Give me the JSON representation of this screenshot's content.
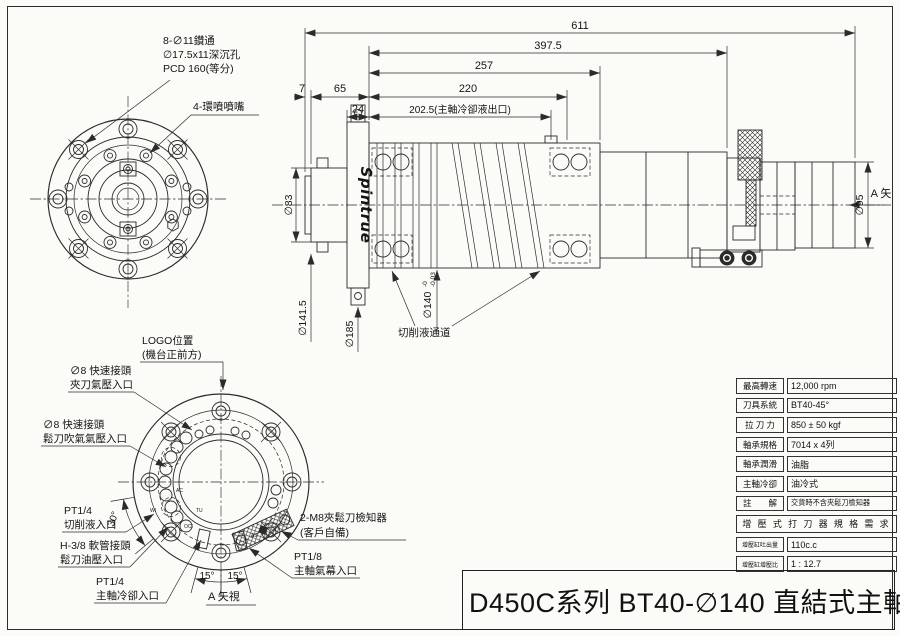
{
  "front_view": {
    "note1": "8-∅11鑽通",
    "note2": "∅17.5x11深沉孔",
    "note3": "PCD 160(等分)",
    "nozzle_note": "4-環噴噴嘴"
  },
  "dims": {
    "overall": "611",
    "d397": "397.5",
    "d257": "257",
    "d220": "220",
    "d202": "202.5(主軸冷卻液出口)",
    "d7": "7",
    "d65": "65",
    "d24": "24",
    "dia83": "∅83",
    "dia141": "∅141.5",
    "dia185": "∅185",
    "dia140": "∅140",
    "dia140_tol_top": "-0",
    "dia140_tol_bot": "-0.03",
    "dia95": "∅95",
    "coolant_channel": "切削液通道",
    "view_arrow": "A 矢"
  },
  "side_view": {
    "logo": "Spintrue"
  },
  "rear_view": {
    "logo_line1": "LOGO位置",
    "logo_line2": "(機台正前方)",
    "clamp_line1": "∅8 快速接頭",
    "clamp_line2": "夾刀氣壓入口",
    "unclamp_line1": "∅8 快速接頭",
    "unclamp_line2": "鬆刀吹氣氣壓入口",
    "coolant_line1": "PT1/4",
    "coolant_line2": "切削液入口",
    "hose_line1": "H-3/8 軟管接頭",
    "hose_line2": "鬆刀油壓入口",
    "spindlecool_line1": "PT1/4",
    "spindlecool_line2": "主軸冷卻入口",
    "detector_line1": "2-M8夾鬆刀檢知器",
    "detector_line2": "(客戶自備)",
    "aircurtain_line1": "PT1/8",
    "aircurtain_line2": "主軸氣幕入口",
    "angle30": "30°",
    "angle15_left": "15°",
    "angle15_right": "15°",
    "view_label": "A 矢視",
    "tag_ac": "AC",
    "tag_tu": "TU",
    "tag_wi": "WI",
    "tag_oci": "OCI",
    "tag_as": "AS"
  },
  "spec_table": {
    "rows": [
      {
        "label": "最高轉速",
        "value": "12,000 rpm"
      },
      {
        "label": "刀具系統",
        "value": "BT40-45°"
      },
      {
        "label": "拉 刀 力",
        "value": "850 ± 50 kgf"
      },
      {
        "label": "軸承規格",
        "value": "7014 x 4列"
      },
      {
        "label": "軸承潤滑",
        "value": "油脂"
      },
      {
        "label": "主軸冷卻",
        "value": "油冷式"
      },
      {
        "label": "註　　解",
        "value": "交貨時不含夾鬆刀檢知器"
      }
    ],
    "booster_header": "增 壓 式 打 刀 器 規 格 需 求",
    "booster_rows": [
      {
        "label": "增壓缸吐出量",
        "value": "110c.c"
      },
      {
        "label": "增壓缸增壓比",
        "value": "1 : 12.7"
      }
    ]
  },
  "title_block": {
    "title": "D450C系列 BT40-∅140 直結式主軸"
  }
}
